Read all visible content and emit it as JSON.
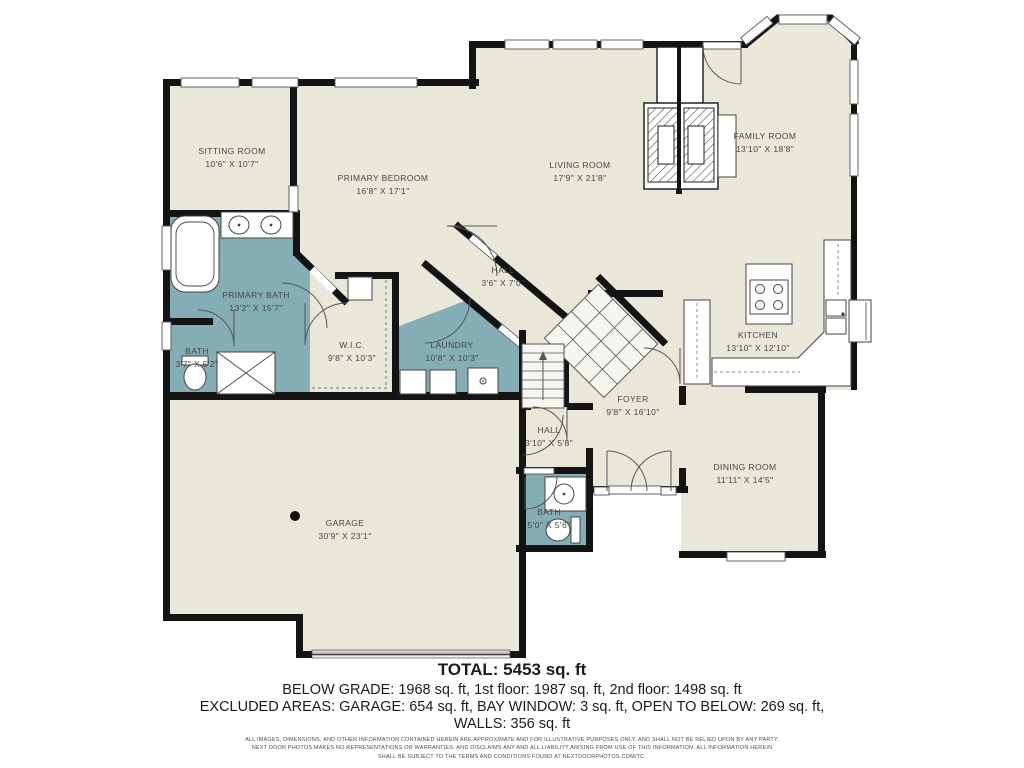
{
  "plan": {
    "rooms": {
      "sitting_room": {
        "name": "SITTING ROOM",
        "dims": "10'6\" X 10'7\""
      },
      "primary_bedroom": {
        "name": "PRIMARY BEDROOM",
        "dims": "16'8\" X 17'1\""
      },
      "living_room": {
        "name": "LIVING ROOM",
        "dims": "17'9\" X 21'8\""
      },
      "family_room": {
        "name": "FAMILY ROOM",
        "dims": "13'10\" X 18'8\""
      },
      "primary_bath": {
        "name": "PRIMARY BATH",
        "dims": "13'2\" X 15'7\""
      },
      "bath_left": {
        "name": "BATH",
        "dims": "3'7\" X 5'2\""
      },
      "wic": {
        "name": "W.I.C.",
        "dims": "9'8\" X 10'3\""
      },
      "laundry": {
        "name": "LAUNDRY",
        "dims": "10'8\" X 10'3\""
      },
      "hall_upper": {
        "name": "HALL",
        "dims": "3'6\" X 7'0\""
      },
      "kitchen": {
        "name": "KITCHEN",
        "dims": "13'10\" X 12'10\""
      },
      "foyer": {
        "name": "FOYER",
        "dims": "9'8\" X 16'10\""
      },
      "dining_room": {
        "name": "DINING ROOM",
        "dims": "11'11\" X 14'5\""
      },
      "hall_lower": {
        "name": "HALL",
        "dims": "3'10\" X 5'8\""
      },
      "bath_center": {
        "name": "BATH",
        "dims": "5'0\" X 5'6\""
      },
      "garage": {
        "name": "GARAGE",
        "dims": "30'9\" X 23'1\""
      }
    },
    "colors": {
      "floor": "#e9e6da",
      "wet_room": "#84adb5",
      "wall": "#141414"
    }
  },
  "summary": {
    "total": "TOTAL: 5453 sq. ft",
    "floors": "BELOW GRADE: 1968 sq. ft, 1st floor: 1987 sq. ft, 2nd floor: 1498 sq. ft",
    "excluded": "EXCLUDED AREAS: GARAGE: 654 sq. ft, BAY WINDOW: 3 sq. ft, OPEN TO BELOW: 269 sq. ft,",
    "walls": "WALLS: 356 sq. ft"
  },
  "disclaimer": {
    "line1": "ALL IMAGES, DIMENSIONS, AND OTHER INFORMATION CONTAINED HEREIN ARE APPROXIMATE AND FOR ILLUSTRATIVE PURPOSES ONLY, AND SHALL NOT BE RELIED UPON BY ANY PARTY.",
    "line2": "NEXT DOOR PHOTOS MAKES NO REPRESENTATIONS OR WARRANTIES, AND DISCLAIMS ANY AND ALL LIABILITY ARISING FROM USE OF THIS INFORMATION. ALL INFORMATION HEREIN",
    "line3": "SHALL BE SUBJECT TO THE TERMS AND CONDITIONS FOUND AT NEXTDOORPHOTOS.COM/TC."
  }
}
